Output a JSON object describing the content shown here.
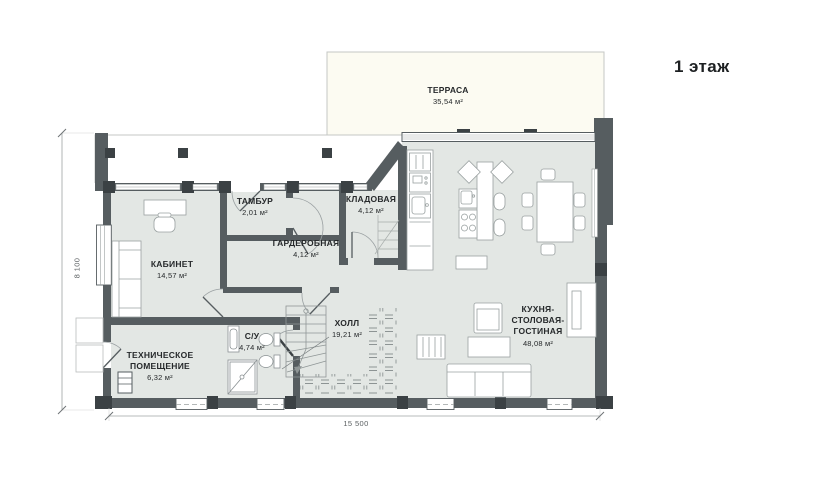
{
  "title": "1 этаж",
  "rooms": [
    {
      "name": "ТЕРРАСА",
      "area": "35,54 м²"
    },
    {
      "name": "ТАМБУР",
      "area": "2,01 м²"
    },
    {
      "name": "КЛАДОВАЯ",
      "area": "4,12 м²"
    },
    {
      "name": "ГАРДЕРОБНАЯ",
      "area": "4,12 м²"
    },
    {
      "name": "КАБИНЕТ",
      "area": "14,57 м²"
    },
    {
      "name": "ХОЛЛ",
      "area": "19,21 м²"
    },
    {
      "name": "С/У",
      "area": "4,74 м²"
    },
    {
      "name": "ТЕХНИЧЕСКОЕ ПОМЕЩЕНИЕ",
      "area": "6,32 м²"
    },
    {
      "name": "КУХНЯ-СТОЛОВАЯ-ГОСТИНАЯ",
      "area": "48,08 м²"
    }
  ],
  "dimensions": {
    "width_label": "15 500",
    "height_label": "8 100"
  },
  "colors": {
    "wall": "#565d60",
    "column": "#3b4144",
    "floor": "#e3e7e4",
    "terrace": "#fcfbf2",
    "text": "#26292b"
  }
}
